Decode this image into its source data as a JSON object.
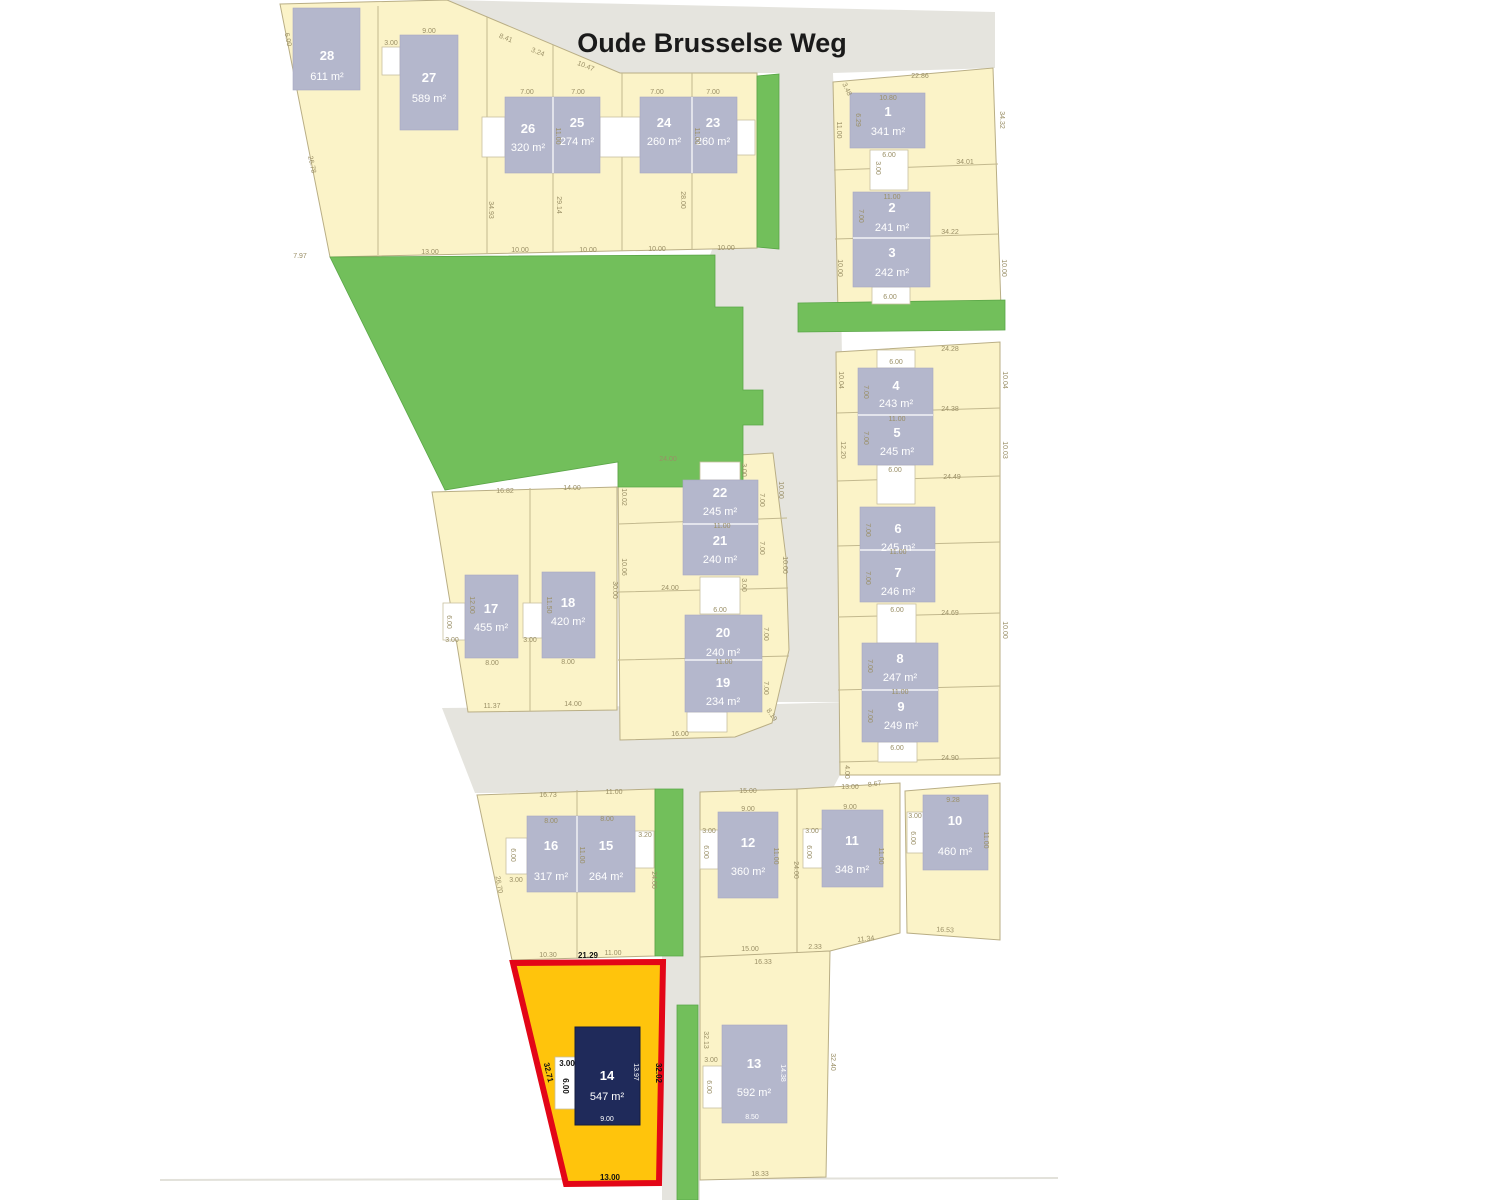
{
  "street": {
    "name": "Oude Brusselse Weg"
  },
  "colors": {
    "parcel_yellow": "#FBF3C8",
    "building_gray": "#B4B7CC",
    "green": "#72BF5B",
    "road_gray": "#E5E4DE",
    "highlight_fill": "#FFC40C",
    "highlight_border": "#E30617",
    "highlight_building": "#1F2A5A"
  },
  "plots": {
    "p1": {
      "num": "1",
      "area": "341 m²"
    },
    "p2": {
      "num": "2",
      "area": "241 m²"
    },
    "p3": {
      "num": "3",
      "area": "242 m²"
    },
    "p4": {
      "num": "4",
      "area": "243 m²"
    },
    "p5": {
      "num": "5",
      "area": "245 m²"
    },
    "p6": {
      "num": "6",
      "area": "245 m²"
    },
    "p7": {
      "num": "7",
      "area": "246 m²"
    },
    "p8": {
      "num": "8",
      "area": "247 m²"
    },
    "p9": {
      "num": "9",
      "area": "249 m²"
    },
    "p10": {
      "num": "10",
      "area": "460 m²"
    },
    "p11": {
      "num": "11",
      "area": "348 m²"
    },
    "p12": {
      "num": "12",
      "area": "360 m²"
    },
    "p13": {
      "num": "13",
      "area": "592 m²"
    },
    "p14": {
      "num": "14",
      "area": "547 m²"
    },
    "p15": {
      "num": "15",
      "area": "264 m²"
    },
    "p16": {
      "num": "16",
      "area": "317 m²"
    },
    "p17": {
      "num": "17",
      "area": "455 m²"
    },
    "p18": {
      "num": "18",
      "area": "420 m²"
    },
    "p19": {
      "num": "19",
      "area": "234 m²"
    },
    "p20": {
      "num": "20",
      "area": "240 m²"
    },
    "p21": {
      "num": "21",
      "area": "240 m²"
    },
    "p22": {
      "num": "22",
      "area": "245 m²"
    },
    "p23": {
      "num": "23",
      "area": "260 m²"
    },
    "p24": {
      "num": "24",
      "area": "260 m²"
    },
    "p25": {
      "num": "25",
      "area": "274 m²"
    },
    "p26": {
      "num": "26",
      "area": "320 m²"
    },
    "p27": {
      "num": "27",
      "area": "589 m²"
    },
    "p28": {
      "num": "28",
      "area": "611 m²"
    }
  },
  "highlight": {
    "dims": {
      "top": "21.29",
      "left": "32.71",
      "right": "32.02",
      "bottom": "13.00",
      "garage_w": "3.00",
      "garage_d": "6.00",
      "house_d": "13.97",
      "house_w": "9.00"
    }
  },
  "dims": {
    "a_bot28": "7.97",
    "a_bot27": "13.00",
    "a_bot26": "10.00",
    "a_bot25": "10.00",
    "a_bot24": "10.00",
    "a_bot23": "10.00",
    "a_b27top": "9.00",
    "a_diag1": "8.41",
    "a_diag2": "3.24",
    "a_diag3": "10.47",
    "a_b26top": "7.00",
    "a_b25top": "7.00",
    "a_b24top": "7.00",
    "a_b23top": "7.00",
    "a_div2625": "11.00",
    "a_div2423": "11.00",
    "a_g27w": "3.00",
    "a_left1": "6.00",
    "a_left2": "26.78",
    "a_col1": "34.93",
    "a_col2": "29.14",
    "a_col3": "28.00",
    "b_top": "22.86",
    "b_diag": "3.48",
    "b_b1top": "10.80",
    "b_b1left": "6.29",
    "b_left1": "11.00",
    "b_line1": "34.01",
    "b_right1": "34.32",
    "b_g1w": "6.00",
    "b_g1d": "3.00",
    "b_b2top": "11.00",
    "b_b2left": "7.00",
    "b_line2": "34.22",
    "b_left2": "10.00",
    "b_right2": "10.00",
    "b_g3w": "6.00",
    "c_top": "24.28",
    "c_g4": "6.00",
    "c_l1": "24.38",
    "c_l2": "24.49",
    "c_l3": "24.69",
    "c_l4": "24.90",
    "c_b45div": "11.00",
    "c_b4l": "7.00",
    "c_b5l": "7.00",
    "c_g5": "6.00",
    "c_b67div": "11.00",
    "c_b6l": "7.00",
    "c_b7l": "7.00",
    "c_g7": "6.00",
    "c_b89div": "11.00",
    "c_b8l": "7.00",
    "c_b9l": "7.00",
    "c_g9": "6.00",
    "c_right1": "10.04",
    "c_right2": "10.03",
    "c_right3": "10.00",
    "c_left1": "10.04",
    "c_left2": "12.20",
    "c_bot": "4.00",
    "c_diag": "8.67",
    "d_top": "24.00",
    "d_div2221": "11.00",
    "d_b22r": "7.00",
    "d_b21r": "7.00",
    "d_line": "24.00",
    "d_g20": "6.00",
    "d_g20s": "3.00",
    "d_gtop": "3.00",
    "d_div2019": "11.00",
    "d_b20r": "7.00",
    "d_b19r": "7.00",
    "d_bot": "16.00",
    "d_diag": "8.19",
    "d_left1": "10.02",
    "d_left2": "10.06",
    "d_right1": "10.00",
    "d_right2": "10.00",
    "e_top17": "16.82",
    "e_top18": "14.00",
    "e_b17l": "12.00",
    "e_g17": "3.00",
    "e_g17d": "6.00",
    "e_b17b": "8.00",
    "e_b18l": "11.50",
    "e_g18": "3.00",
    "e_b18b": "8.00",
    "e_right": "30.00",
    "e_bot17": "11.37",
    "e_bot18": "14.00",
    "f_top16": "16.73",
    "f_top15": "11.00",
    "f_b16t": "8.00",
    "f_b15t": "8.00",
    "f_g16d": "6.00",
    "f_g16": "3.00",
    "f_div": "11.00",
    "f_g15": "3.20",
    "f_right": "24.00",
    "f_diag": "26.70",
    "f_bot16": "10.30",
    "f_bot15": "11.00",
    "g_top12": "15.00",
    "g_top11": "13.00",
    "g_b12t": "9.00",
    "g_g12": "3.00",
    "g_g12d": "6.00",
    "g_b12r": "11.00",
    "g_r12": "24.00",
    "g_b11t": "9.00",
    "g_g11": "3.00",
    "g_g11d": "6.00",
    "g_b11r": "11.00",
    "g_b10t": "9.28",
    "g_g10": "3.00",
    "g_g10d": "6.00",
    "g_b10r": "11.00",
    "g_bot10": "16.53",
    "g_bot11": "11.34",
    "g_233": "2.33",
    "g_bot12": "15.00",
    "g_top13": "16.33",
    "g_l13": "32.13",
    "g_r13": "32.40",
    "g_b13r": "14.38",
    "g_b13b": "8.50",
    "g_g13d": "6.00",
    "g_g13": "3.00",
    "g_bot13": "18.33"
  }
}
